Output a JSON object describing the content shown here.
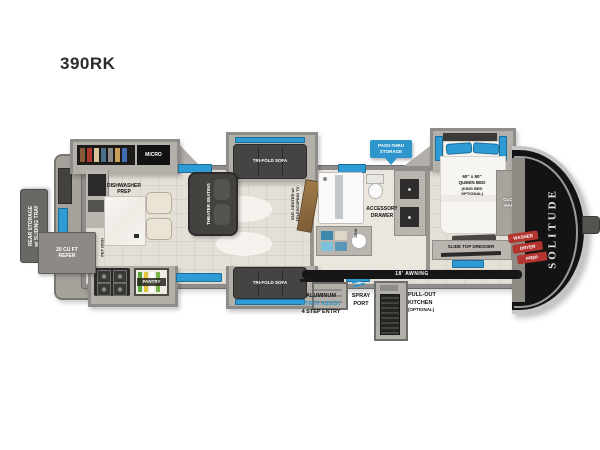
{
  "title": "390RK",
  "brand": "SOLITUDE",
  "colors": {
    "accent_blue": "#2e96cc",
    "window_blue": "#2f9bd4",
    "wall_gray": "#8f8d8a",
    "floor_beige": "#e4dfd7",
    "cap_black": "#131313",
    "label_red": "#b23530"
  },
  "badges": {
    "pass_thru": {
      "line1": "PASS-THRU",
      "line2": "STORAGE"
    }
  },
  "kitchen": {
    "rear_storage": {
      "line1": "REAR STORAGE",
      "line2": "w/ SLIDING TRAY"
    },
    "refer": {
      "line1": "20 CU FT",
      "line2": "REFER"
    },
    "micro": "MICRO",
    "dishwasher": {
      "line1": "DISHWASHER",
      "line2": "PREP"
    },
    "pet_dish": "PET DISH",
    "pantry": "PANTRY"
  },
  "living": {
    "sofa_top": "TRI-FOLD SOFA",
    "sofa_bottom": "TRI-FOLD SOFA",
    "theater": "THEATER SEATING",
    "ent_center": {
      "line1": "ENT. CENTER w/",
      "line2": "TELESCOPING TV"
    }
  },
  "bath": {
    "accessory": {
      "line1": "ACCESSORY",
      "line2": "DRAWER"
    },
    "sink": "SINK"
  },
  "bedroom": {
    "bed": {
      "line1": "60\" x 80\"",
      "line2": "QUEEN BED",
      "line3": "(KING BED",
      "line4": "OPTIONAL)"
    },
    "hamper": {
      "line1": "CLOTHES",
      "line2": "HAMPER"
    },
    "washer": {
      "line1": "WASHER",
      "line2": "DRYER",
      "line3": "PREP"
    },
    "dresser": "SLIDE TOP DRESSER"
  },
  "exterior": {
    "awning": "18' AWNING",
    "entry": {
      "line1": "ALUMINUM",
      "line2": "STRUT ASSIST",
      "line3": "4 STEP ENTRY"
    },
    "spray": {
      "line1": "SPRAY",
      "line2": "PORT"
    },
    "pullout": {
      "line1": "PULL-OUT",
      "line2": "KITCHEN",
      "line3": "(OPTIONAL)"
    }
  }
}
